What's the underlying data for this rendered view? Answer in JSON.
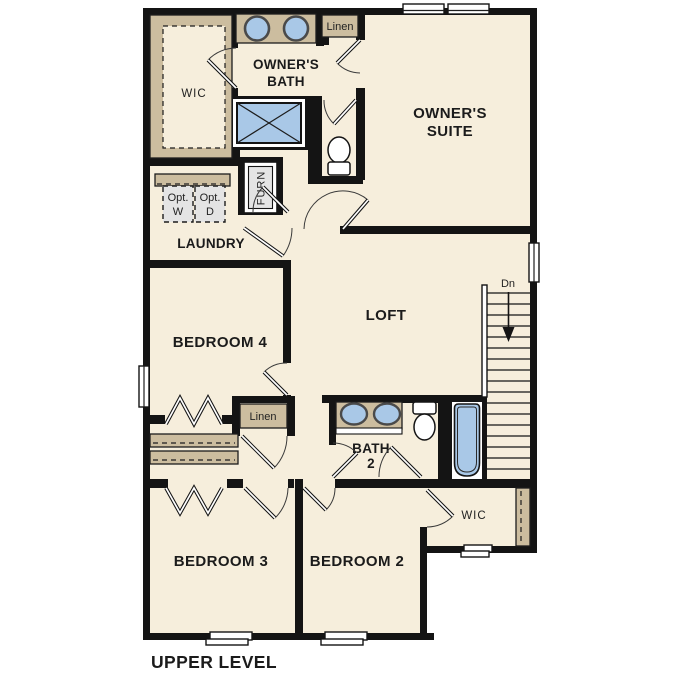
{
  "title": "UPPER LEVEL",
  "colors": {
    "floor": "#f6eedc",
    "wall": "#141414",
    "tan": "#ccbd9f",
    "fixture": "#a9c8e7",
    "appliance": "#e4e4e4",
    "text": "#1b1b1b",
    "paper": "#ffffff"
  },
  "rooms": {
    "wic_top": {
      "label": "WIC"
    },
    "owners_bath": {
      "line1": "OWNER'S",
      "line2": "BATH"
    },
    "linen_top": {
      "label": "Linen"
    },
    "owners_suite": {
      "line1": "OWNER'S",
      "line2": "SUITE"
    },
    "laundry": {
      "label": "LAUNDRY"
    },
    "furnace": {
      "label": "FURN"
    },
    "opt_washer": {
      "line1": "Opt.",
      "line2": "W"
    },
    "opt_dryer": {
      "line1": "Opt.",
      "line2": "D"
    },
    "bedroom4": {
      "label": "BEDROOM 4"
    },
    "loft": {
      "label": "LOFT"
    },
    "stairs": {
      "label": "Dn"
    },
    "linen_mid": {
      "label": "Linen"
    },
    "bath2": {
      "line1": "BATH",
      "line2": "2"
    },
    "wic_bottom": {
      "label": "WIC"
    },
    "bedroom3": {
      "label": "BEDROOM 3"
    },
    "bedroom2": {
      "label": "BEDROOM 2"
    }
  }
}
